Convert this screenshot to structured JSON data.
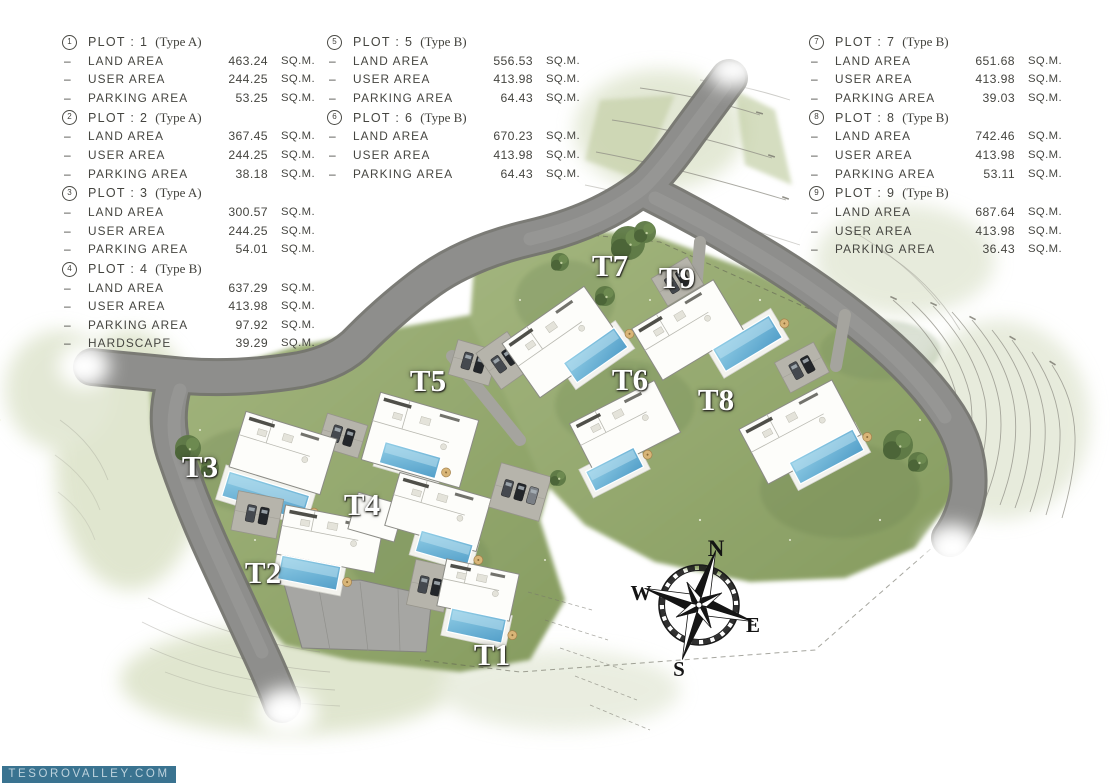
{
  "legend": {
    "plots": [
      {
        "num": "1",
        "title": "PLOT : 1",
        "type": "(Type A)",
        "rows": [
          {
            "label": "LAND AREA",
            "value": "463.24",
            "unit": "SQ.M."
          },
          {
            "label": "USER AREA",
            "value": "244.25",
            "unit": "SQ.M."
          },
          {
            "label": "PARKING AREA",
            "value": "53.25",
            "unit": "SQ.M."
          }
        ]
      },
      {
        "num": "2",
        "title": "PLOT : 2",
        "type": "(Type A)",
        "rows": [
          {
            "label": "LAND AREA",
            "value": "367.45",
            "unit": "SQ.M."
          },
          {
            "label": "USER AREA",
            "value": "244.25",
            "unit": "SQ.M."
          },
          {
            "label": "PARKING AREA",
            "value": "38.18",
            "unit": "SQ.M."
          }
        ]
      },
      {
        "num": "3",
        "title": "PLOT : 3",
        "type": "(Type A)",
        "rows": [
          {
            "label": "LAND AREA",
            "value": "300.57",
            "unit": "SQ.M."
          },
          {
            "label": "USER AREA",
            "value": "244.25",
            "unit": "SQ.M."
          },
          {
            "label": "PARKING AREA",
            "value": "54.01",
            "unit": "SQ.M."
          }
        ]
      },
      {
        "num": "4",
        "title": "PLOT : 4",
        "type": "(Type B)",
        "rows": [
          {
            "label": "LAND AREA",
            "value": "637.29",
            "unit": "SQ.M."
          },
          {
            "label": "USER AREA",
            "value": "413.98",
            "unit": "SQ.M."
          },
          {
            "label": "PARKING AREA",
            "value": "97.92",
            "unit": "SQ.M."
          },
          {
            "label": "HARDSCAPE",
            "value": "39.29",
            "unit": "SQ.M."
          }
        ]
      },
      {
        "num": "5",
        "title": "PLOT : 5",
        "type": "(Type B)",
        "rows": [
          {
            "label": "LAND AREA",
            "value": "556.53",
            "unit": "SQ.M."
          },
          {
            "label": "USER AREA",
            "value": "413.98",
            "unit": "SQ.M."
          },
          {
            "label": "PARKING AREA",
            "value": "64.43",
            "unit": "SQ.M."
          }
        ]
      },
      {
        "num": "6",
        "title": "PLOT : 6",
        "type": "(Type B)",
        "rows": [
          {
            "label": "LAND AREA",
            "value": "670.23",
            "unit": "SQ.M."
          },
          {
            "label": "USER AREA",
            "value": "413.98",
            "unit": "SQ.M."
          },
          {
            "label": "PARKING AREA",
            "value": "64.43",
            "unit": "SQ.M."
          }
        ]
      },
      {
        "num": "7",
        "title": "PLOT : 7",
        "type": "(Type B)",
        "rows": [
          {
            "label": "LAND AREA",
            "value": "651.68",
            "unit": "SQ.M."
          },
          {
            "label": "USER AREA",
            "value": "413.98",
            "unit": "SQ.M."
          },
          {
            "label": "PARKING AREA",
            "value": "39.03",
            "unit": "SQ.M."
          }
        ]
      },
      {
        "num": "8",
        "title": "PLOT : 8",
        "type": "(Type B)",
        "rows": [
          {
            "label": "LAND AREA",
            "value": "742.46",
            "unit": "SQ.M."
          },
          {
            "label": "USER AREA",
            "value": "413.98",
            "unit": "SQ.M."
          },
          {
            "label": "PARKING AREA",
            "value": "53.11",
            "unit": "SQ.M."
          }
        ]
      },
      {
        "num": "9",
        "title": "PLOT : 9",
        "type": "(Type B)",
        "rows": [
          {
            "label": "LAND AREA",
            "value": "687.64",
            "unit": "SQ.M."
          },
          {
            "label": "USER AREA",
            "value": "413.98",
            "unit": "SQ.M."
          },
          {
            "label": "PARKING AREA",
            "value": "36.43",
            "unit": "SQ.M."
          }
        ]
      }
    ],
    "columns": [
      {
        "left": 62,
        "plot_indexes": [
          0,
          1,
          2,
          3
        ]
      },
      {
        "left": 327,
        "plot_indexes": [
          4,
          5
        ]
      },
      {
        "left": 809,
        "plot_indexes": [
          6,
          7,
          8
        ]
      }
    ]
  },
  "map": {
    "unit_labels": [
      {
        "text": "T1",
        "x": 492,
        "y": 655
      },
      {
        "text": "T2",
        "x": 263,
        "y": 573
      },
      {
        "text": "T3",
        "x": 200,
        "y": 467
      },
      {
        "text": "T4",
        "x": 362,
        "y": 505
      },
      {
        "text": "T5",
        "x": 428,
        "y": 381
      },
      {
        "text": "T6",
        "x": 630,
        "y": 380
      },
      {
        "text": "T7",
        "x": 610,
        "y": 266
      },
      {
        "text": "T8",
        "x": 716,
        "y": 400
      },
      {
        "text": "T9",
        "x": 677,
        "y": 278
      }
    ],
    "compass": {
      "n": "N",
      "e": "E",
      "s": "S",
      "w": "W"
    }
  },
  "watermark": {
    "text": "TESOROVALLEY.COM"
  },
  "colors": {
    "road": "#8e8e8c",
    "road_edge": "#74746f",
    "grass": "#96a873",
    "grass_dark": "#718756",
    "pool": "#539fc9",
    "pool_light": "#93cfe7",
    "building": "#fdfdfa",
    "watermark_bg": "#3a7390",
    "legend_text": "#454540",
    "label_text": "#ffffff"
  }
}
